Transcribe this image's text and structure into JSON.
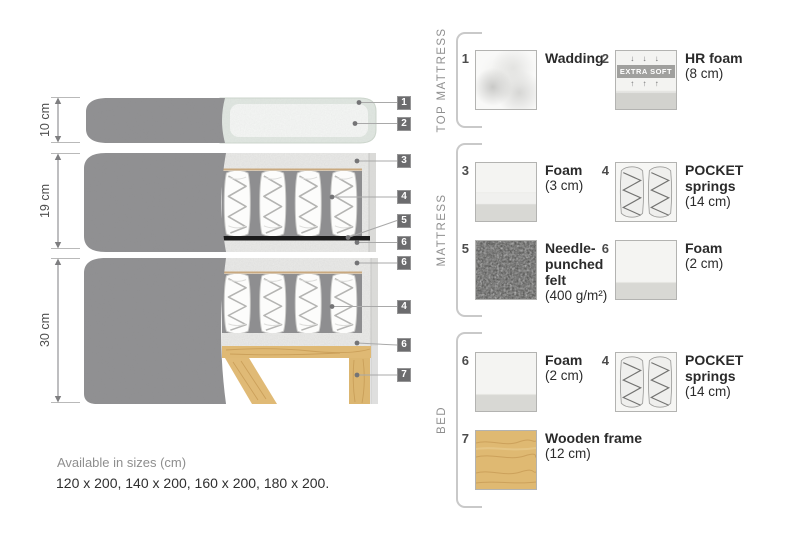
{
  "diagram": {
    "dimensions": [
      {
        "label": "10 cm"
      },
      {
        "label": "19 cm"
      },
      {
        "label": "30 cm"
      }
    ],
    "badges": [
      {
        "num": "1"
      },
      {
        "num": "2"
      },
      {
        "num": "3"
      },
      {
        "num": "4"
      },
      {
        "num": "5"
      },
      {
        "num": "6"
      },
      {
        "num": "6"
      },
      {
        "num": "4"
      },
      {
        "num": "6"
      },
      {
        "num": "7"
      }
    ],
    "footnote_title": "Available in sizes (cm)",
    "footnote_sizes": "120 x 200, 140 x 200, 160 x 200, 180 x 200."
  },
  "legend": {
    "sections": [
      {
        "label": "TOP MATTRESS"
      },
      {
        "label": "MATTRESS"
      },
      {
        "label": "BED"
      }
    ],
    "items": [
      {
        "num": "1",
        "name": "Wadding",
        "sub": ""
      },
      {
        "num": "2",
        "name": "HR foam",
        "sub": "(8 cm)",
        "swatch": {
          "extra_soft": "EXTRA SOFT",
          "arrows_down": "↓ ↓ ↓",
          "arrows_up": "↑ ↑ ↑"
        }
      },
      {
        "num": "3",
        "name": "Foam",
        "sub": "(3 cm)"
      },
      {
        "num": "4",
        "name": "POCKET\nsprings",
        "sub": "(14 cm)"
      },
      {
        "num": "5",
        "name": "Needle-\npunched\nfelt",
        "sub": "(400 g/m²)"
      },
      {
        "num": "6",
        "name": "Foam",
        "sub": "(2 cm)"
      },
      {
        "num": "6",
        "name": "Foam",
        "sub": "(2 cm)"
      },
      {
        "num": "4",
        "name": "POCKET\nsprings",
        "sub": "(14 cm)"
      },
      {
        "num": "7",
        "name": "Wooden frame",
        "sub": "(12 cm)"
      }
    ]
  },
  "colors": {
    "cover_gray": "#919193",
    "foam_light": "#ebebe9",
    "spring_gap_gray": "#8e8e90",
    "felt_black": "#1b1b1b",
    "wood_tan": "#dfb974",
    "badge_gray": "#6c6c6e",
    "wadding_green": "#e1e8e2"
  }
}
